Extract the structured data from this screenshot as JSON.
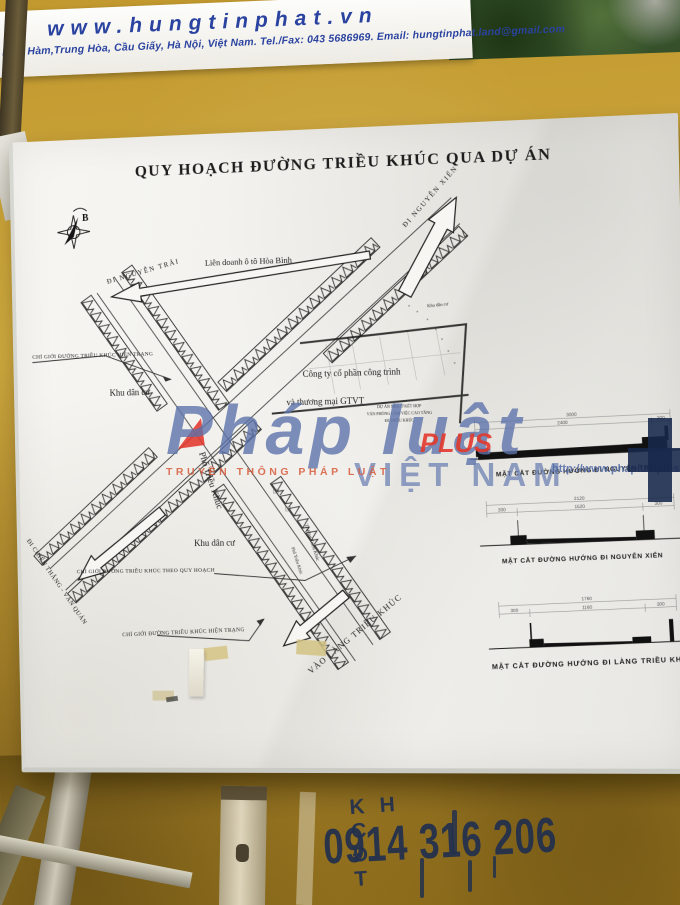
{
  "banner": {
    "website": "www.hungtinphat.vn",
    "contact": "ham Hàm,Trung Hòa, Cầu Giấy, Hà Nội, Việt Nam. Tel./Fax: 043 5686969. Email: hungtinphat.land@gmail.com"
  },
  "board": {
    "title": "QUY HOẠCH ĐƯỜNG TRIỀU KHÚC QUA DỰ ÁN",
    "compass_label": "B",
    "labels": {
      "di_nguyen_trai": "ĐI NGUYỄN TRÃI",
      "di_nguyen_xien": "ĐI NGUYỄN XIỂN",
      "lien_doanh": "Liên doanh ô tô Hòa Bình",
      "khu_dan_cu_tay": "Khu dân cư",
      "khu_dan_cu_nam": "Khu dân cư",
      "khu_dan_cu_nho": "Khu dân cư",
      "cong_ty_line1": "Công ty cổ phần công trình",
      "cong_ty_line2": "và thương mại GTVT",
      "du_an_line1": "DỰ ÁN NHÀ Ở KẾT HỢP",
      "du_an_line2": "VĂN PHÒNG LÀM VIỆC CAO TẦNG",
      "du_an_line3": "ĐI TRIỀU KHÚC",
      "chi_gioi_hien_trang_tren": "CHỈ GIỚI ĐƯỜNG TRIỀU KHÚC HIỆN TRẠNG",
      "chi_gioi_quy_hoach": "CHỈ GIỚI ĐƯỜNG TRIỀU KHÚC THEO QUY HOẠCH",
      "chi_gioi_hien_trang_duoi": "CHỈ GIỚI ĐƯỜNG TRIỀU KHÚC HIỆN TRẠNG",
      "pho_trieu_khuc": "Phố Triều Khúc",
      "pho_trieu_khuc_nho": "Phố Triều Khúc",
      "truong_trieu_khuc": "Trường Triều Khúc",
      "di_chien_thang": "ĐI CHIẾN THẮNG - VĂN QUÁN",
      "vao_lang_trieu_khuc": "VÀO LÀNG TRIỀU KHÚC"
    },
    "cross_sections": [
      {
        "caption": "MẶT CẮT ĐƯỜNG HƯỚNG ĐI NGUYỄN TRÃI",
        "total": "3000",
        "seg_left": "",
        "seg_mid": "2400",
        "seg_right": "300"
      },
      {
        "caption": "MẶT CẮT ĐƯỜNG HƯỚNG ĐI NGUYỄN XIỂN",
        "total": "2120",
        "seg_left": "300",
        "seg_mid": "1520",
        "seg_right": "300"
      },
      {
        "caption": "MẶT CẮT ĐƯỜNG HƯỚNG ĐI LÀNG TRIỀU KHÚC",
        "total": "1760",
        "seg_left": "300",
        "seg_mid": "1160",
        "seg_right": "300"
      }
    ]
  },
  "watermark": {
    "brand": "Pháp luật",
    "plus": "PLUS",
    "country": "VIỆT NAM",
    "tagline": "TRUYỀN THÔNG PHÁP LUẬT",
    "url": "http://www.phapluatplus.vn",
    "colors": {
      "blue": "#5c73aa",
      "red": "#e2372c"
    }
  },
  "graffiti": {
    "line1": "KH C Đ T",
    "line2": "0914 316 206",
    "color": "#22304e"
  }
}
